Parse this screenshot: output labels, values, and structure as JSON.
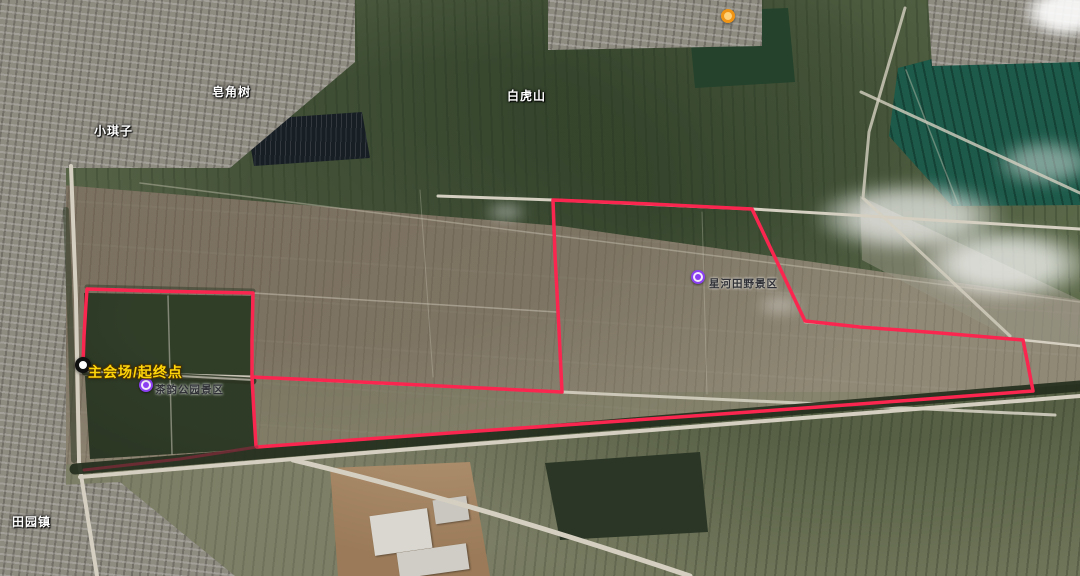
{
  "labels": {
    "xiaoqizi": "小琪子",
    "zaojiaoshu": "皂角树",
    "baihushan": "白虎山",
    "xinghe": "星河田野景区",
    "start": "主会场/起终点",
    "chayun": "茶韵公园景区",
    "tianyuan": "田园镇"
  },
  "route": {
    "color": "#fb2650",
    "return_color": "#9c2740",
    "pond": "83,365 84,336 86,303 87,289 150,291 253,293 252,340 252,377 254,414 256,446",
    "loop": "252,377 340,381 460,387 562,392 559,330 555,255 553,200 650,204 752,209 779,266 805,321 860,327 940,333 1023,340 1028,365 1033,391 900,401 750,412 450,433 257,447",
    "retrn": "257,447 180,459 110,467 84,470"
  },
  "colors": {
    "poi_marker": "#8a3ff0",
    "orange_marker": "#ef9415",
    "start_label": "#ffd60a",
    "water_field": "#1d5a49"
  }
}
